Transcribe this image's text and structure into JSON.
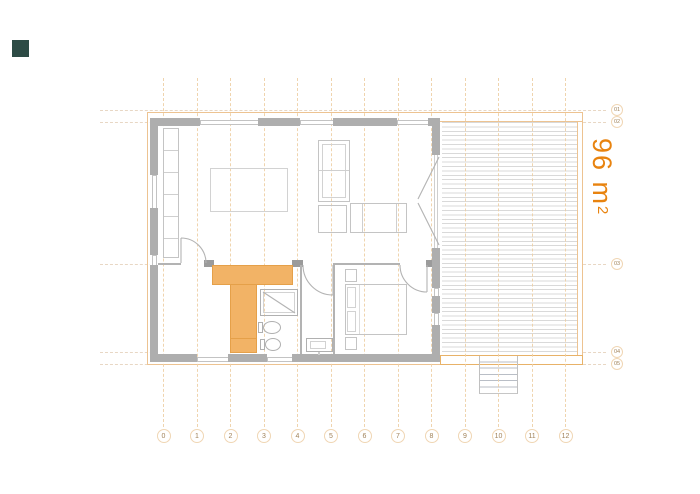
{
  "title": "floor-plan",
  "logo": {
    "color": "#2d4b45"
  },
  "area_label": {
    "value": "96 m",
    "exponent": "2",
    "color": "#e8830f"
  },
  "grid": {
    "columns": [
      "0",
      "1",
      "2",
      "3",
      "4",
      "5",
      "6",
      "7",
      "8",
      "9",
      "10",
      "11",
      "12"
    ],
    "rows": [
      "01",
      "02",
      "03",
      "04",
      "05"
    ],
    "line_color": "#eed0a6",
    "circle_border_color": "#f0d6b4",
    "number_color": "#a08259"
  },
  "plan": {
    "wall_color": "#aeaeae",
    "furniture_line_color": "#c4c4c4",
    "highlight_fill": "#f2b366",
    "highlight_border": "#e5a049",
    "roof_line_color": "#edc391",
    "deck_plank_color": "#d9d9d9",
    "elements": [
      "kitchen-counter",
      "dining-table",
      "sofa-unit",
      "armchair",
      "chaise",
      "entry-hall",
      "bathroom",
      "shower",
      "toilet",
      "bidet",
      "bedroom",
      "double-bed",
      "nightstand",
      "closet",
      "washbasin",
      "deck",
      "stairs",
      "french-doors"
    ]
  }
}
